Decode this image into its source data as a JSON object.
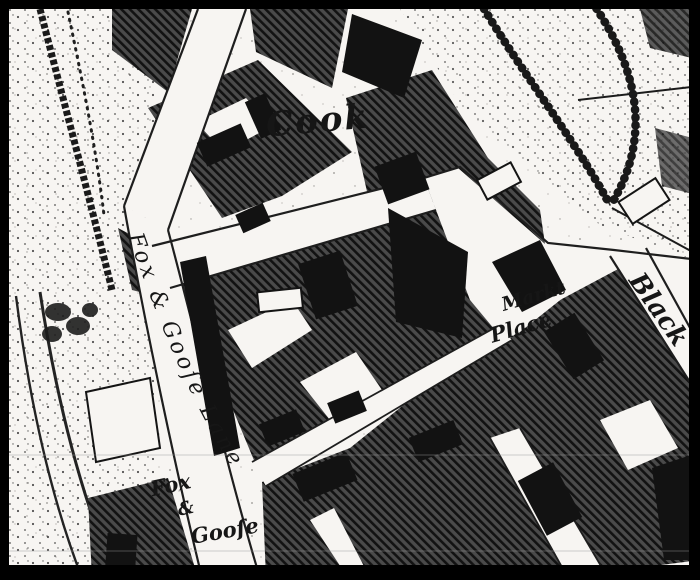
{
  "map": {
    "colors": {
      "paper": "#f7f5f2",
      "ink": "#161616"
    },
    "labels": {
      "cook": "Cook",
      "fox_and_goose_lane": "Fox & Gooſe Lane",
      "fox_and_goose": {
        "line1": "Fox",
        "line2": "&",
        "line3": "Gooſe"
      },
      "market_place": {
        "line1": "Markt",
        "line2": "Place"
      },
      "black_street": "Black"
    }
  }
}
